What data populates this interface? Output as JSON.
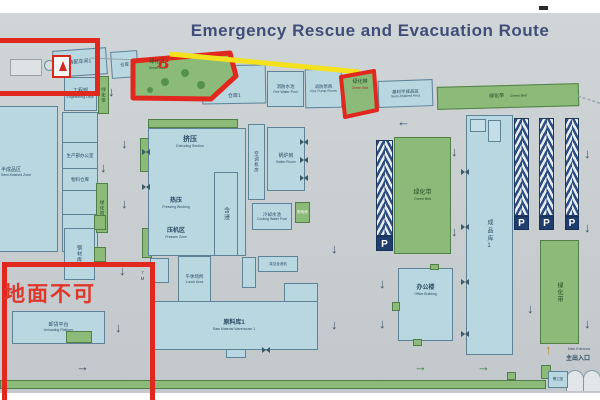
{
  "title": "Emergency Rescue and Evacuation Route",
  "annotations": {
    "handwriting": "地面不可",
    "red_mark": "B"
  },
  "labels": {
    "green_belt": "绿化带",
    "green_belt_en": "Green Belt",
    "parking": "P",
    "road_width": "7M"
  },
  "arrows": {
    "down": "↓",
    "left": "←",
    "right": "→",
    "up": "↑"
  },
  "top_row": {
    "workshop1": "装配车间1",
    "store": "仓库",
    "warehouse1": "仓库1",
    "fire_pool": "消防水池",
    "fire_pool_en": "Fire Water Pool",
    "fire_pump": "消防泵房",
    "fire_pump_en": "Fire Pump Room",
    "base_material": "基材半成品区",
    "base_material_en": "Semi-finished Area"
  },
  "left_area": {
    "engineering": "工程部",
    "engineering_en": "Engineering Dept.",
    "semi_finished": "半成品区",
    "semi_finished_en": "Semi-finished Zone",
    "production_office": "生产部办公室",
    "material_store": "物料仓库",
    "steel_store": "钢材库",
    "unloading": "卸货平台",
    "unloading_en": "Unloading Platform"
  },
  "center_area": {
    "extrusion": "挤压",
    "extrusion_en": "Extruding Section",
    "hot_press": "热压",
    "hot_press_en": "Pressing Working",
    "press_zone": "压机区",
    "press_zone_en": "Presses Zone",
    "impregnation": "含浸",
    "ac_room": "空调机房",
    "boiler": "锅炉房",
    "boiler_en": "Boiler Room",
    "cooling_pool": "冷却水池",
    "cooling_pool_en": "Cooling Water Pool",
    "power_room": "配电房",
    "lunch_area": "午休场所",
    "lunch_en": "Lunch Area",
    "vacuum_machine": "真空含浸机",
    "raw_warehouse": "原料库1",
    "raw_warehouse_en": "Raw Material Warehouse 1"
  },
  "right_area": {
    "office_building": "办公楼",
    "office_building_en": "Office Building",
    "finished_warehouse": "成品库1",
    "guard_room": "警卫室",
    "entrance": "主出入口",
    "entrance_en": "Main Entrance"
  },
  "colors": {
    "red": "#e0281e",
    "yellow": "#f2e11c",
    "green": "#8cbb79",
    "building": "#b9d7e1",
    "navy": "#2e4d80"
  }
}
